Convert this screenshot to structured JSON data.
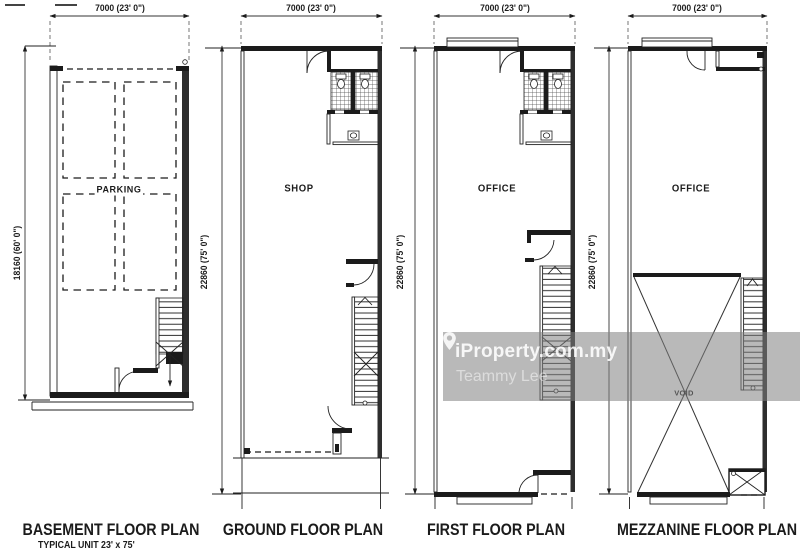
{
  "sheet": {
    "background": "#ffffff",
    "line_color": "#1b1b1b",
    "wall_fill": "#2e2e2e"
  },
  "plans": [
    {
      "id": "basement",
      "title": "BASEMENT FLOOR PLAN",
      "subtitle": "TYPICAL UNIT 23' x 75'",
      "width_dim": "7000  (23' 0\")",
      "depth_dim": "18160  (60' 0\")",
      "room_label": "PARKING"
    },
    {
      "id": "ground",
      "title": "GROUND FLOOR PLAN",
      "width_dim": "7000  (23' 0\")",
      "depth_dim": "22860  (75' 0\")",
      "room_label": "SHOP"
    },
    {
      "id": "first",
      "title": "FIRST FLOOR PLAN",
      "width_dim": "7000  (23' 0\")",
      "depth_dim": "22860  (75' 0\")",
      "room_label": "OFFICE"
    },
    {
      "id": "mezzanine",
      "title": "MEZZANINE FLOOR PLAN",
      "width_dim": "7000  (23' 0\")",
      "depth_dim": "22860  (75' 0\")",
      "room_label": "OFFICE",
      "void_label": "VOID"
    }
  ],
  "watermark": {
    "brand": "iProperty.com.my",
    "agent": "Teammy Lee",
    "band_color": "rgba(127,127,127,0.55)",
    "text_color": "#ffffff"
  }
}
